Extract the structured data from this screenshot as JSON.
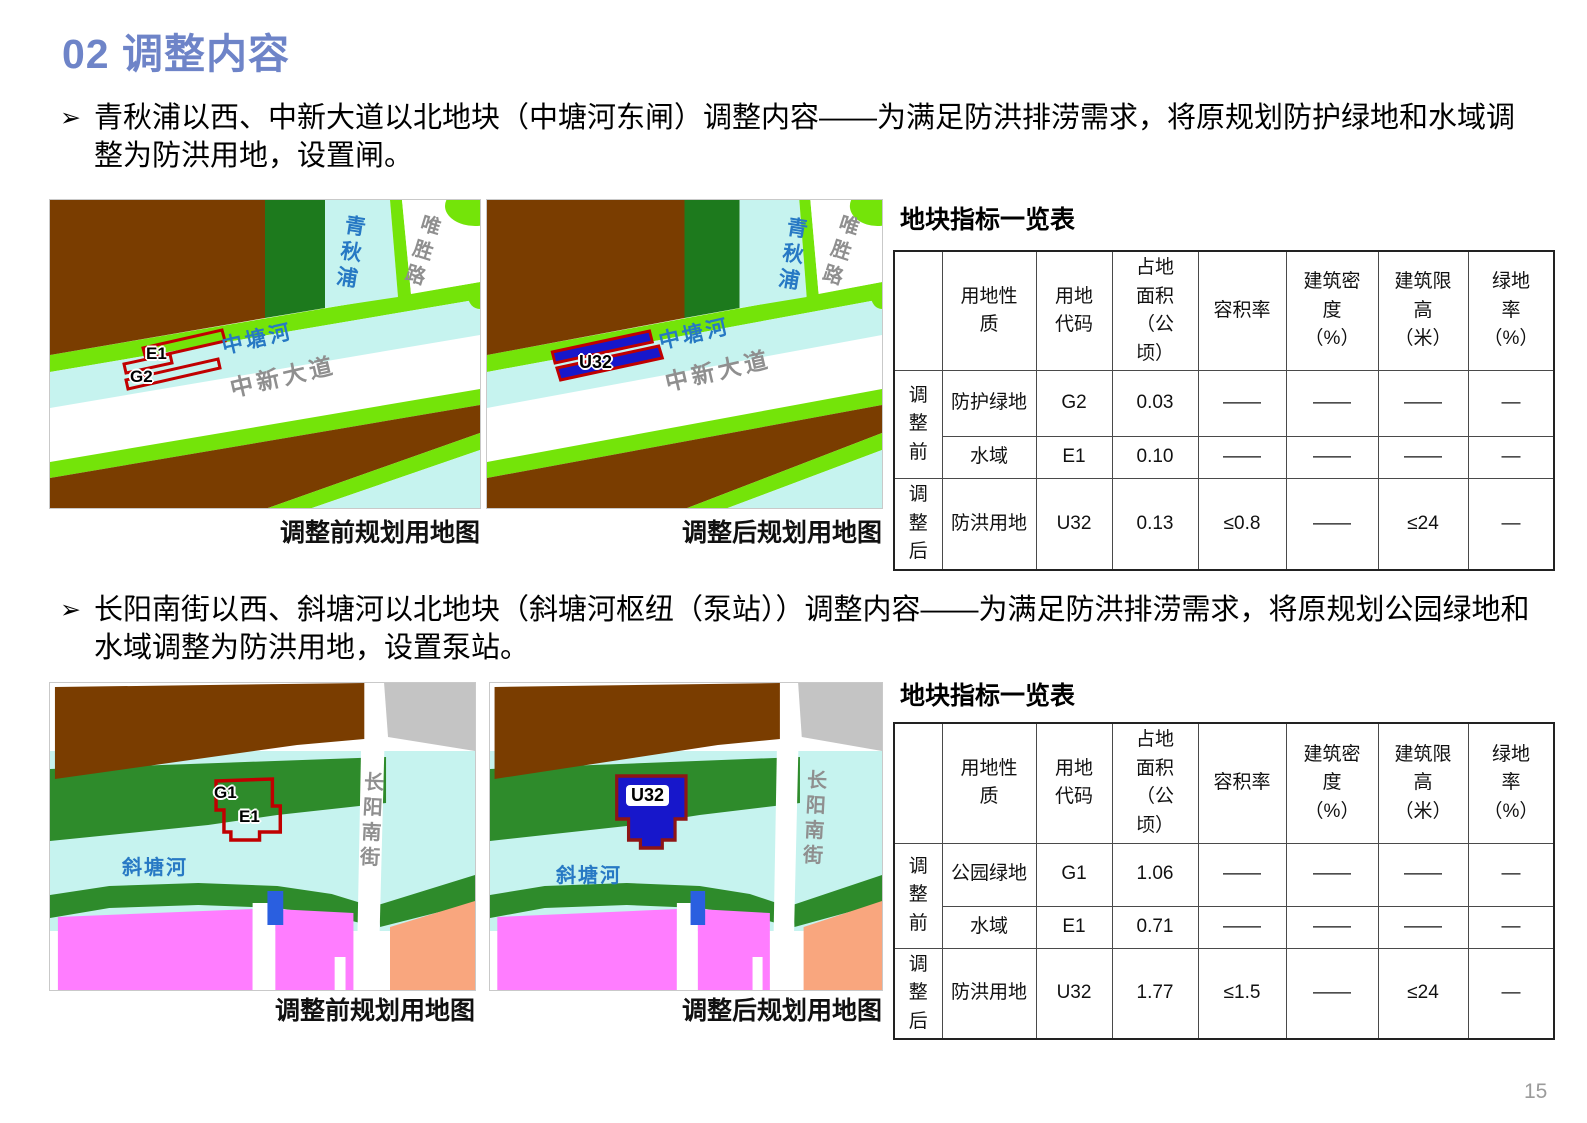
{
  "title": "02 调整内容",
  "page_number": "15",
  "colors": {
    "title_blue": "#6E84C8",
    "map_land_brown": "#7A3D00",
    "map_buffer_green": "#74E409",
    "map_water_cyan": "#C6F3EF",
    "map_dark_green": "#1D7A1D",
    "map_forest_green": "#2E8B2B",
    "map_residential_pink": "#FF7DFF",
    "map_salmon": "#F9A67E",
    "map_gray_parcel": "#C4C4C4",
    "map_parcel_blue": "#1717CB",
    "map_outline_red": "#C00000",
    "river_label_blue": "#2779C4",
    "road_label_gray": "#8F8F8F"
  },
  "section1": {
    "bullet": "青秋浦以西、中新大道以北地块（中塘河东闸）调整内容——为满足防洪排涝需求，将原规划防护绿地和水域调整为防洪用地，设置闸。",
    "map_before": {
      "caption": "调整前规划用地图",
      "labels": {
        "river_vertical": "青秋浦",
        "road_vertical": "唯胜路",
        "river_diagonal": "中塘河",
        "road_diagonal": "中新大道",
        "parcel_e1": "E1",
        "parcel_g2": "G2"
      }
    },
    "map_after": {
      "caption": "调整后规划用地图",
      "labels": {
        "river_vertical": "青秋浦",
        "road_vertical": "唯胜路",
        "river_diagonal": "中塘河",
        "road_diagonal": "中新大道",
        "parcel_u32": "U32"
      }
    },
    "table": {
      "title": "地块指标一览表",
      "headers": [
        "",
        "用地性质",
        "用地代码",
        "占地面积（公顷）",
        "容积率",
        "建筑密度（%）",
        "建筑限高（米）",
        "绿地率（%）"
      ],
      "row_groups": [
        "调整前",
        "调整后"
      ],
      "rows": [
        {
          "nature": "防护绿地",
          "code": "G2",
          "area": "0.03",
          "far": "——",
          "density": "——",
          "height_limit": "——",
          "green_rate": "—"
        },
        {
          "nature": "水域",
          "code": "E1",
          "area": "0.10",
          "far": "——",
          "density": "——",
          "height_limit": "——",
          "green_rate": "—"
        },
        {
          "nature": "防洪用地",
          "code": "U32",
          "area": "0.13",
          "far": "≤0.8",
          "density": "——",
          "height_limit": "≤24",
          "green_rate": "—"
        }
      ]
    }
  },
  "section2": {
    "bullet": "长阳南街以西、斜塘河以北地块（斜塘河枢纽（泵站））调整内容——为满足防洪排涝需求，将原规划公园绿地和水域调整为防洪用地，设置泵站。",
    "map_before": {
      "caption": "调整前规划用地图",
      "labels": {
        "river": "斜塘河",
        "road_vertical": "长阳南街",
        "parcel_g1": "G1",
        "parcel_e1": "E1"
      }
    },
    "map_after": {
      "caption": "调整后规划用地图",
      "labels": {
        "river": "斜塘河",
        "road_vertical": "长阳南街",
        "parcel_u32": "U32"
      }
    },
    "table": {
      "title": "地块指标一览表",
      "headers": [
        "",
        "用地性质",
        "用地代码",
        "占地面积（公顷）",
        "容积率",
        "建筑密度（%）",
        "建筑限高（米）",
        "绿地率（%）"
      ],
      "row_groups": [
        "调整前",
        "调整后"
      ],
      "rows": [
        {
          "nature": "公园绿地",
          "code": "G1",
          "area": "1.06",
          "far": "——",
          "density": "——",
          "height_limit": "——",
          "green_rate": "—"
        },
        {
          "nature": "水域",
          "code": "E1",
          "area": "0.71",
          "far": "——",
          "density": "——",
          "height_limit": "——",
          "green_rate": "—"
        },
        {
          "nature": "防洪用地",
          "code": "U32",
          "area": "1.77",
          "far": "≤1.5",
          "density": "——",
          "height_limit": "≤24",
          "green_rate": "—"
        }
      ]
    }
  }
}
